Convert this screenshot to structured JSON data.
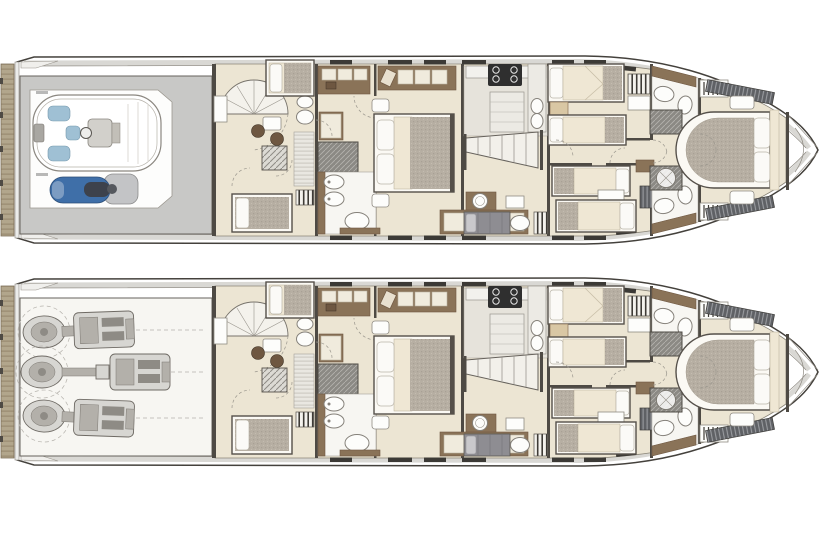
{
  "figure": {
    "kind": "yacht-deck-plan-drawing",
    "orientation": "bow-right-stern-left",
    "plans_shown": 2,
    "visible_text": "none-legible"
  },
  "plans": [
    {
      "id": "plan-a-top",
      "position": "top",
      "aft_compartment": "tender-garage",
      "aft_items": [
        "swim-platform",
        "tender-boat",
        "jet-ski"
      ],
      "forward_layout": "accommodation"
    },
    {
      "id": "plan-b-bottom",
      "position": "bottom",
      "aft_compartment": "engine-room",
      "aft_items": [
        "swim-platform",
        "engine-starboard",
        "engine-center",
        "engine-port"
      ],
      "engines_count": 3,
      "forward_layout": "accommodation"
    }
  ],
  "accommodation": {
    "rooms": [
      "crew-quarters-with-spiral-stair",
      "master-suite",
      "master-bathroom-with-shower",
      "galley",
      "main-staircase",
      "day-head-cabin",
      "guest-cabin-starboard-twin",
      "guest-cabin-port-twin",
      "bathroom-starboard",
      "bathroom-port",
      "vip-cabin-forward",
      "forepeak"
    ],
    "berths": {
      "master_double": 1,
      "vip_double": 1,
      "guest_singles": 4,
      "crew_berths": 3
    }
  },
  "palette": {
    "paper": "#ffffff",
    "line": "#44413c",
    "lineSoft": "#8f8b83",
    "wall": "#4e4a44",
    "bulwark": "#d9d8d4",
    "teak": "#b2a68c",
    "teakStripe": "#94866b",
    "floorCream": "#ece5d3",
    "floorWhite": "#f7f6f2",
    "floorGray": "#c8c8c6",
    "galleyFloor": "#e6e3db",
    "wood": "#8a7358",
    "woodDark": "#6e5741",
    "mattress": "#efe7d4",
    "duvet": "#b7afa3",
    "pillow": "#fbfaf7",
    "cushion": "#f0ebdd",
    "slat": "#5f6165",
    "showerBase": "#8b8984",
    "hatchBase": "#dcdad4",
    "machineLight": "#d7d6d2",
    "machineMid": "#b3b0aa",
    "machineDark": "#8e8b85",
    "seatBlue": "#9fc0d4",
    "jetskiBlue": "#3f6fa8",
    "jetskiGray": "#c3c4c6",
    "berthGray": "#8e8d92"
  }
}
